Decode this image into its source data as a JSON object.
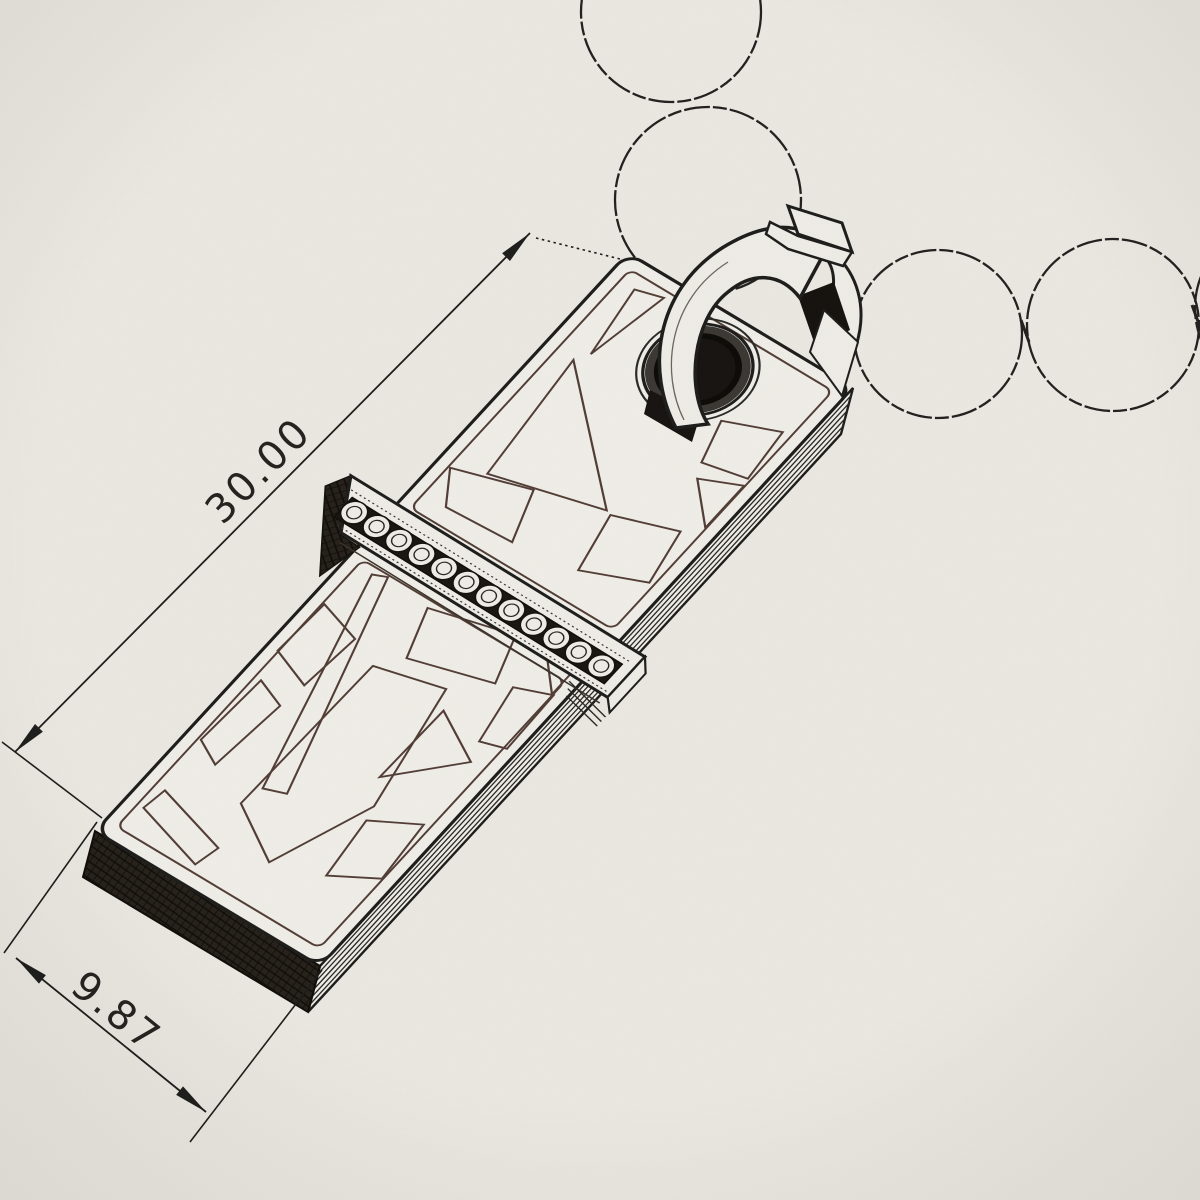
{
  "document": {
    "kind": "technical-sketch",
    "subject": "rectangular tag pendant with pave gem band hanging on a bead chain",
    "view": "isometric-perspective"
  },
  "paper": {
    "color": "#ebe9e2",
    "ink": "#1d1d1b",
    "pattern_ink": "#513d36",
    "shadow": "#26211a"
  },
  "dimensions": {
    "length": {
      "label": "30.00"
    },
    "width": {
      "label": "9.87"
    }
  },
  "chain": {
    "bead_count": 5
  },
  "pendant": {
    "gem_count": 12,
    "features": [
      "eyelet",
      "bail",
      "bail-cap",
      "gem-band",
      "engraved-geometric-pattern",
      "stacked-plate-edges"
    ]
  }
}
